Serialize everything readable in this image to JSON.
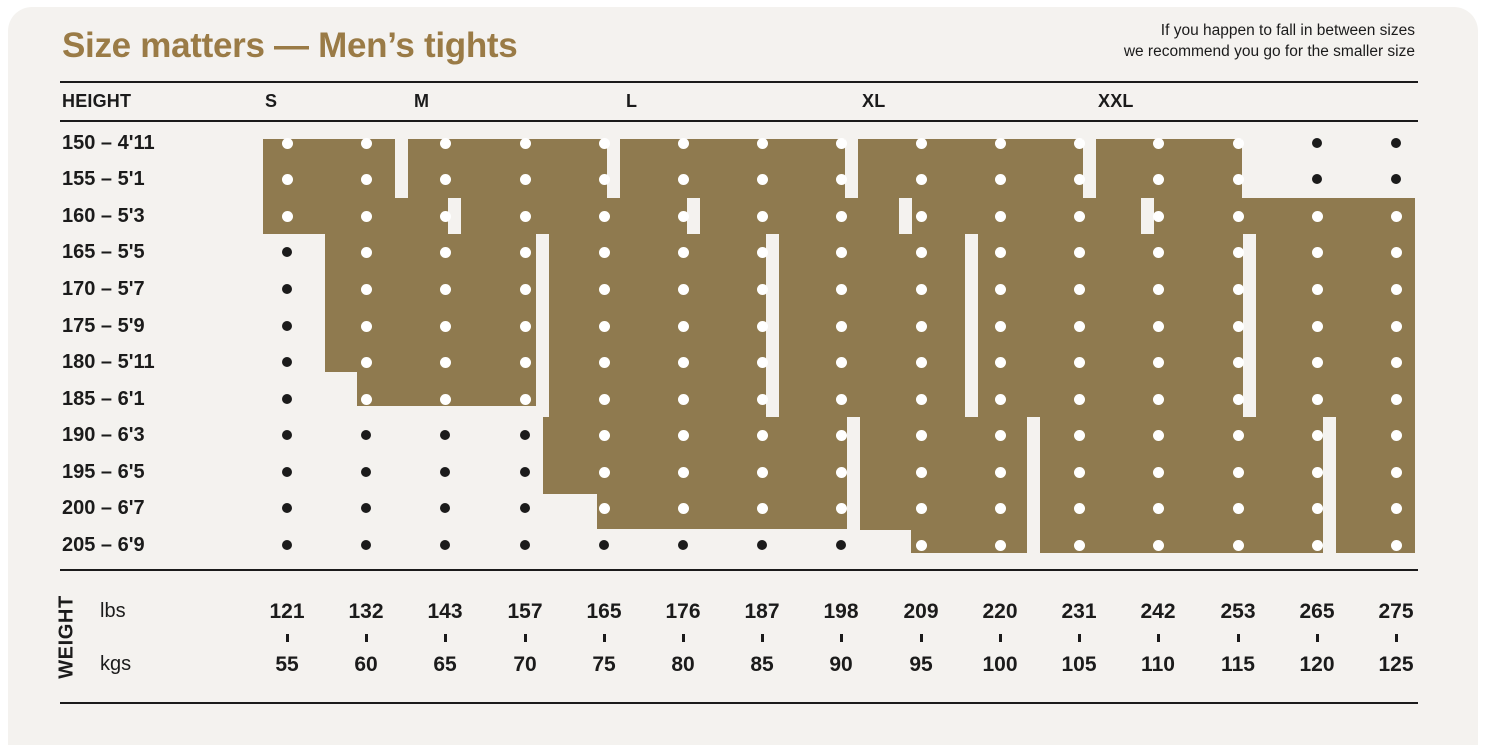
{
  "title": "Size matters — Men’s tights",
  "note": {
    "line1": "If you happen to fall in between sizes",
    "line2": "we recommend you go for the smaller size"
  },
  "header": {
    "height_label": "HEIGHT",
    "sizes": [
      "S",
      "M",
      "L",
      "XL",
      "XXL"
    ]
  },
  "heights": [
    "150 – 4'11",
    "155 – 5'1",
    "160 – 5'3",
    "165 – 5'5",
    "170 – 5'7",
    "175 – 5'9",
    "180 – 5'11",
    "185 – 6'1",
    "190 – 6'3",
    "195 – 6'5",
    "200 – 6'7",
    "205 – 6'9"
  ],
  "weight": {
    "label": "WEIGHT",
    "unit_top": "lbs",
    "unit_bottom": "kgs",
    "lbs": [
      "121",
      "132",
      "143",
      "157",
      "165",
      "176",
      "187",
      "198",
      "209",
      "220",
      "231",
      "242",
      "253",
      "265",
      "275"
    ],
    "kgs": [
      "55",
      "60",
      "65",
      "70",
      "75",
      "80",
      "85",
      "90",
      "95",
      "100",
      "105",
      "110",
      "115",
      "120",
      "125"
    ]
  },
  "colors": {
    "gold": "#8f7a4f",
    "title_gold": "#9a7b46",
    "background": "#f4f2ef",
    "outside": "#ffffff",
    "ink": "#1b1b1b",
    "dot_covered": "#ffffff"
  },
  "chart_data": {
    "type": "heatmap",
    "title": "Size matters — Men’s tights",
    "xlabel": "WEIGHT (lbs / kgs)",
    "ylabel": "HEIGHT (cm / ft)",
    "x_kgs": [
      55,
      60,
      65,
      70,
      75,
      80,
      85,
      90,
      95,
      100,
      105,
      110,
      115,
      120,
      125
    ],
    "x_lbs": [
      121,
      132,
      143,
      157,
      165,
      176,
      187,
      198,
      209,
      220,
      231,
      242,
      253,
      265,
      275
    ],
    "y_heights_cm": [
      150,
      155,
      160,
      165,
      170,
      175,
      180,
      185,
      190,
      195,
      200,
      205
    ],
    "y_heights_ft": [
      "4'11",
      "5'1",
      "5'3",
      "5'5",
      "5'7",
      "5'9",
      "5'11",
      "6'1",
      "6'3",
      "6'5",
      "6'7",
      "6'9"
    ],
    "legend": "gold region = size fits this height/weight combination; black dot = combination not covered",
    "sizes": [
      {
        "name": "S",
        "coverage": [
          {
            "heights_cm": [
              150,
              155
            ],
            "kgs": [
              55,
              60
            ]
          },
          {
            "heights_cm": [
              160,
              160
            ],
            "kgs": [
              55,
              65
            ]
          },
          {
            "heights_cm": [
              165,
              185
            ],
            "kgs": [
              60,
              70
            ]
          }
        ]
      },
      {
        "name": "M",
        "coverage": [
          {
            "heights_cm": [
              150,
              155
            ],
            "kgs": [
              65,
              75
            ]
          },
          {
            "heights_cm": [
              160,
              160
            ],
            "kgs": [
              70,
              80
            ]
          },
          {
            "heights_cm": [
              165,
              185
            ],
            "kgs": [
              75,
              85
            ]
          },
          {
            "heights_cm": [
              190,
              200
            ],
            "kgs": [
              75,
              90
            ]
          }
        ]
      },
      {
        "name": "L",
        "coverage": [
          {
            "heights_cm": [
              150,
              155
            ],
            "kgs": [
              80,
              90
            ]
          },
          {
            "heights_cm": [
              160,
              160
            ],
            "kgs": [
              85,
              90
            ]
          },
          {
            "heights_cm": [
              165,
              185
            ],
            "kgs": [
              90,
              95
            ]
          },
          {
            "heights_cm": [
              190,
              205
            ],
            "kgs": [
              95,
              100
            ]
          }
        ]
      },
      {
        "name": "XL",
        "coverage": [
          {
            "heights_cm": [
              150,
              160
            ],
            "kgs": [
              95,
              105
            ]
          },
          {
            "heights_cm": [
              165,
              185
            ],
            "kgs": [
              100,
              115
            ]
          },
          {
            "heights_cm": [
              190,
              205
            ],
            "kgs": [
              105,
              120
            ]
          }
        ]
      },
      {
        "name": "XXL",
        "coverage": [
          {
            "heights_cm": [
              150,
              155
            ],
            "kgs": [
              110,
              115
            ]
          },
          {
            "heights_cm": [
              160,
              160
            ],
            "kgs": [
              110,
              125
            ]
          },
          {
            "heights_cm": [
              165,
              185
            ],
            "kgs": [
              120,
              125
            ]
          },
          {
            "heights_cm": [
              190,
              205
            ],
            "kgs": [
              125,
              125
            ]
          }
        ]
      }
    ]
  },
  "layout": {
    "col_x": [
      287,
      366,
      445,
      525,
      604,
      683,
      762,
      841,
      921,
      1000,
      1079,
      1158,
      1238,
      1317,
      1396
    ],
    "row_y": [
      143,
      179,
      216,
      252,
      289,
      326,
      362,
      399,
      435,
      472,
      508,
      545
    ],
    "size_label_x": [
      265,
      414,
      626,
      862,
      1098
    ],
    "coverage_cols_by_row": [
      [
        1,
        13
      ],
      [
        1,
        13
      ],
      [
        1,
        15
      ],
      [
        2,
        15
      ],
      [
        2,
        15
      ],
      [
        2,
        15
      ],
      [
        2,
        15
      ],
      [
        2,
        15
      ],
      [
        5,
        15
      ],
      [
        5,
        15
      ],
      [
        5,
        15
      ],
      [
        9,
        15
      ]
    ],
    "regions": [
      {
        "size": "S",
        "x": 263,
        "y": 139,
        "w": 132,
        "h": 59
      },
      {
        "size": "S",
        "x": 263,
        "y": 198,
        "w": 185,
        "h": 36
      },
      {
        "size": "S",
        "x": 325,
        "y": 234,
        "w": 211,
        "h": 138
      },
      {
        "size": "S",
        "x": 357,
        "y": 372,
        "w": 179,
        "h": 34
      },
      {
        "size": "M",
        "x": 408,
        "y": 139,
        "w": 199,
        "h": 59
      },
      {
        "size": "M",
        "x": 461,
        "y": 198,
        "w": 226,
        "h": 36
      },
      {
        "size": "M",
        "x": 549,
        "y": 234,
        "w": 217,
        "h": 183
      },
      {
        "size": "M",
        "x": 543,
        "y": 417,
        "w": 304,
        "h": 77
      },
      {
        "size": "M",
        "x": 597,
        "y": 494,
        "w": 250,
        "h": 35
      },
      {
        "size": "L",
        "x": 620,
        "y": 139,
        "w": 225,
        "h": 59
      },
      {
        "size": "L",
        "x": 700,
        "y": 198,
        "w": 199,
        "h": 36
      },
      {
        "size": "L",
        "x": 779,
        "y": 234,
        "w": 186,
        "h": 183
      },
      {
        "size": "L",
        "x": 860,
        "y": 417,
        "w": 167,
        "h": 113
      },
      {
        "size": "L",
        "x": 911,
        "y": 530,
        "w": 116,
        "h": 23
      },
      {
        "size": "XL",
        "x": 858,
        "y": 139,
        "w": 225,
        "h": 59
      },
      {
        "size": "XL",
        "x": 912,
        "y": 198,
        "w": 229,
        "h": 36
      },
      {
        "size": "XL",
        "x": 978,
        "y": 234,
        "w": 265,
        "h": 183
      },
      {
        "size": "XL",
        "x": 1040,
        "y": 417,
        "w": 283,
        "h": 136
      },
      {
        "size": "XXL",
        "x": 1096,
        "y": 139,
        "w": 146,
        "h": 59
      },
      {
        "size": "XXL",
        "x": 1154,
        "y": 198,
        "w": 261,
        "h": 36
      },
      {
        "size": "XXL",
        "x": 1256,
        "y": 234,
        "w": 159,
        "h": 183
      },
      {
        "size": "XXL",
        "x": 1336,
        "y": 417,
        "w": 79,
        "h": 136
      }
    ]
  }
}
